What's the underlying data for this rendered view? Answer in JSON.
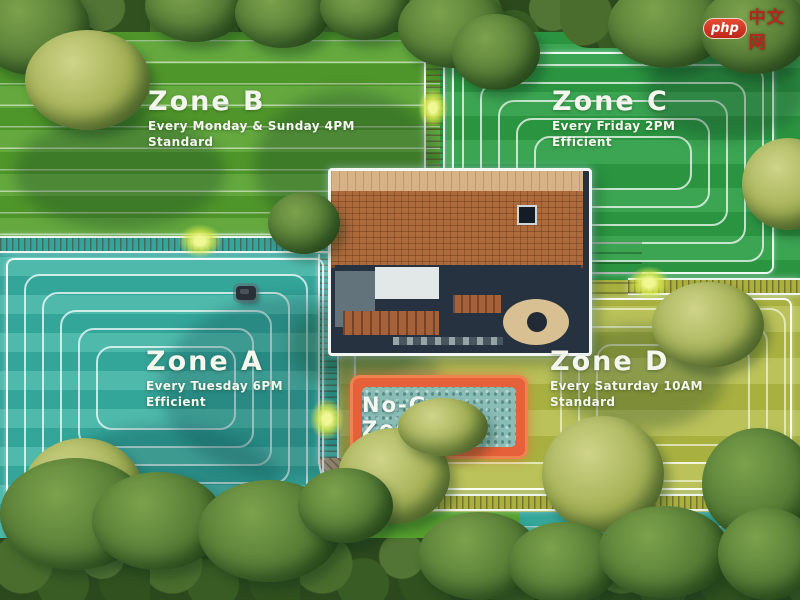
{
  "scene": {
    "description": "Top-down lawn map with mowing zones around a house",
    "no_go_zone": {
      "label": "No-Go Zone",
      "border_color": "#e6603a",
      "water_color": "#8abdb6"
    }
  },
  "zones": [
    {
      "name": "Zone A",
      "schedule": "Every Tuesday 6PM",
      "mode": "Efficient",
      "grass_color": "#3bb2a3"
    },
    {
      "name": "Zone B",
      "schedule": "Every Monday & Sunday 4PM",
      "mode": "Standard",
      "grass_color": "#58a22f"
    },
    {
      "name": "Zone C",
      "schedule": "Every Friday 2PM",
      "mode": "Efficient",
      "grass_color": "#2f9f47"
    },
    {
      "name": "Zone D",
      "schedule": "Every Saturday 10AM",
      "mode": "Standard",
      "grass_color": "#b3bc49"
    }
  ],
  "watermark": {
    "logo_text": "php",
    "site_text": "中文网"
  }
}
